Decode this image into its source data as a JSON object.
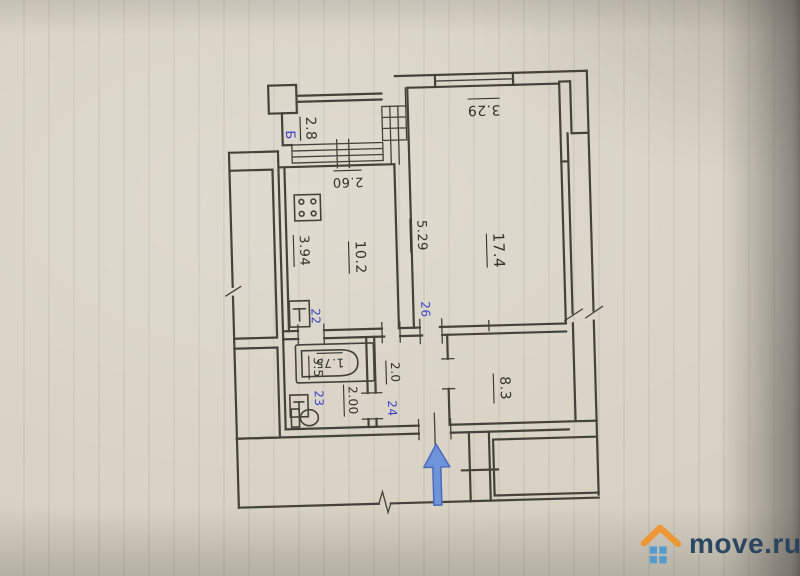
{
  "plan": {
    "rooms": {
      "balcony": {
        "tag": "Б",
        "area": "2.8"
      },
      "kitchen": {
        "area": "10.2",
        "width": "2.60",
        "depth": "3.94",
        "door_tag": "22"
      },
      "living_room": {
        "area": "17.4",
        "width": "3.29",
        "depth": "5.29",
        "door_tag": "26"
      },
      "bathroom": {
        "area": "3.5",
        "width": "2.00",
        "tub_length": "1.75",
        "door_tag": "23"
      },
      "corridor": {
        "width": "2.0",
        "door_tag": "24"
      },
      "hallway": {
        "area": "8.3"
      }
    },
    "colors": {
      "wall_ink": "#45423a",
      "label_ink": "#35322c",
      "tag_blue": "#3b42c4",
      "arrow_blue": "#6e93d9",
      "paper": "#d7d1c3"
    }
  },
  "watermark": {
    "text": "move.ru",
    "text_color": "#24415f",
    "roof_color": "#ef9530",
    "window_color": "#4f9ad2"
  }
}
